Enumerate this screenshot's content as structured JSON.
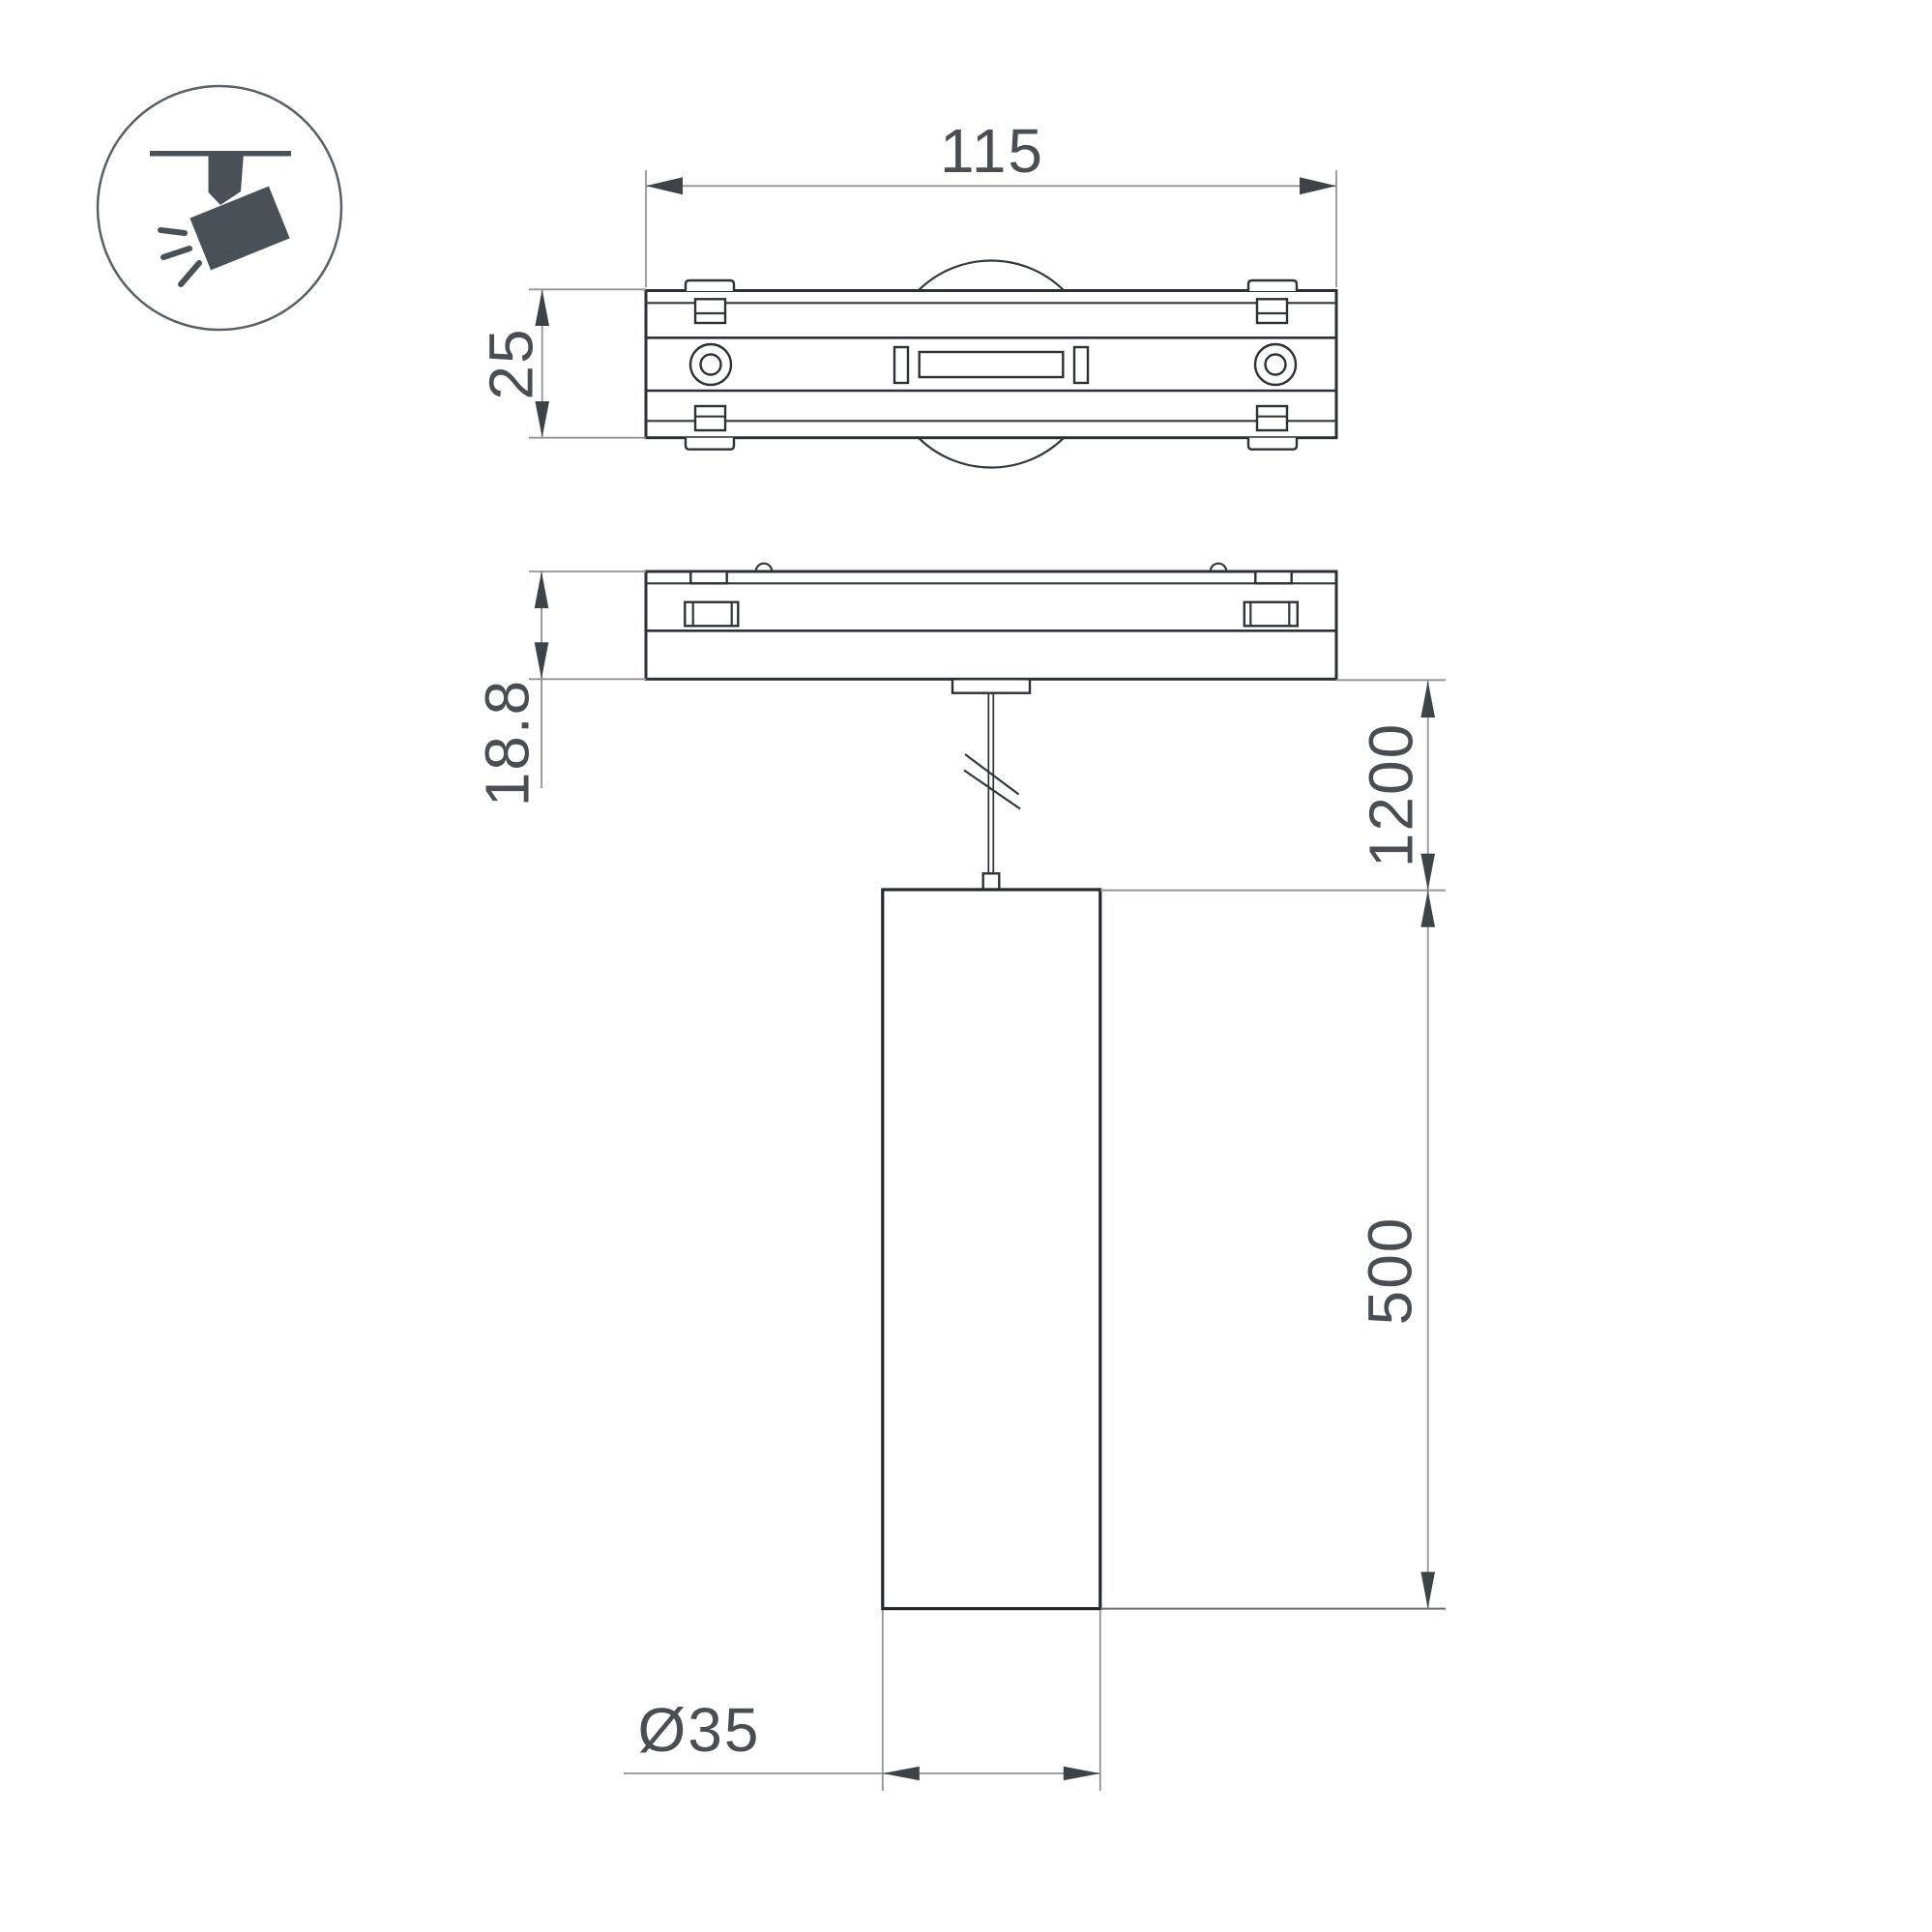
{
  "drawing": {
    "type": "technical-dimension-drawing",
    "subject": "magnetic-track-pendant-spot-luminaire",
    "icon": {
      "name": "track-spotlight",
      "glyph_color": "#495056",
      "ring_color": "#5a6065"
    },
    "dims": {
      "track_width": {
        "value": "115"
      },
      "track_depth": {
        "value": "25"
      },
      "track_height": {
        "value": "18.8"
      },
      "suspension_length": {
        "value": "1200"
      },
      "tube_length": {
        "value": "500"
      },
      "tube_diameter": {
        "value": "Ø35"
      }
    },
    "colors": {
      "outline": "#2d3135",
      "dimension_line": "#939393",
      "arrow": "#3e4347",
      "text": "#4a4e52",
      "background": "#ffffff"
    }
  }
}
